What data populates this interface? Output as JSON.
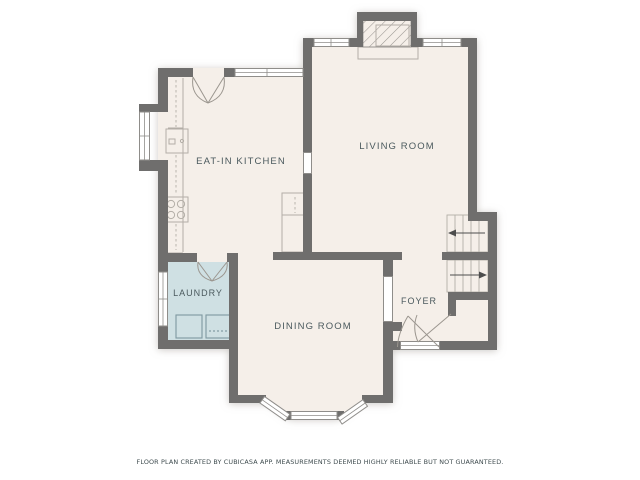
{
  "plan": {
    "rooms": [
      {
        "id": "eat-in-kitchen",
        "label": "EAT-IN KITCHEN"
      },
      {
        "id": "living-room",
        "label": "LIVING ROOM"
      },
      {
        "id": "laundry",
        "label": "LAUNDRY"
      },
      {
        "id": "dining-room",
        "label": "DINING ROOM"
      },
      {
        "id": "foyer",
        "label": "FOYER"
      }
    ],
    "footer": "FLOOR PLAN CREATED BY CUBICASA APP. MEASUREMENTS DEEMED HIGHLY RELIABLE BUT NOT GUARANTEED.",
    "fixtures": [
      "fireplace-hatch",
      "hearth",
      "sink-icon",
      "stove-icon",
      "cabinet",
      "washer-icon",
      "dryer-icon",
      "stairs-up-run",
      "stairs-down-run",
      "entry-door",
      "closet-door",
      "kitchen-double-door",
      "laundry-door",
      "bay-window"
    ],
    "colors": {
      "floor": "#f5efe9",
      "laundry": "#cfe0e3",
      "wall": "#6f6e6d",
      "thin": "#8f8d8a",
      "fixline": "#b3aea7",
      "doorline": "#9b968f",
      "arrow": "#4d4d4d",
      "appliance": "#7e98a0",
      "label": "#4b5a5e",
      "footer": "#3e4b4e",
      "shadow": "#a39d96"
    }
  }
}
